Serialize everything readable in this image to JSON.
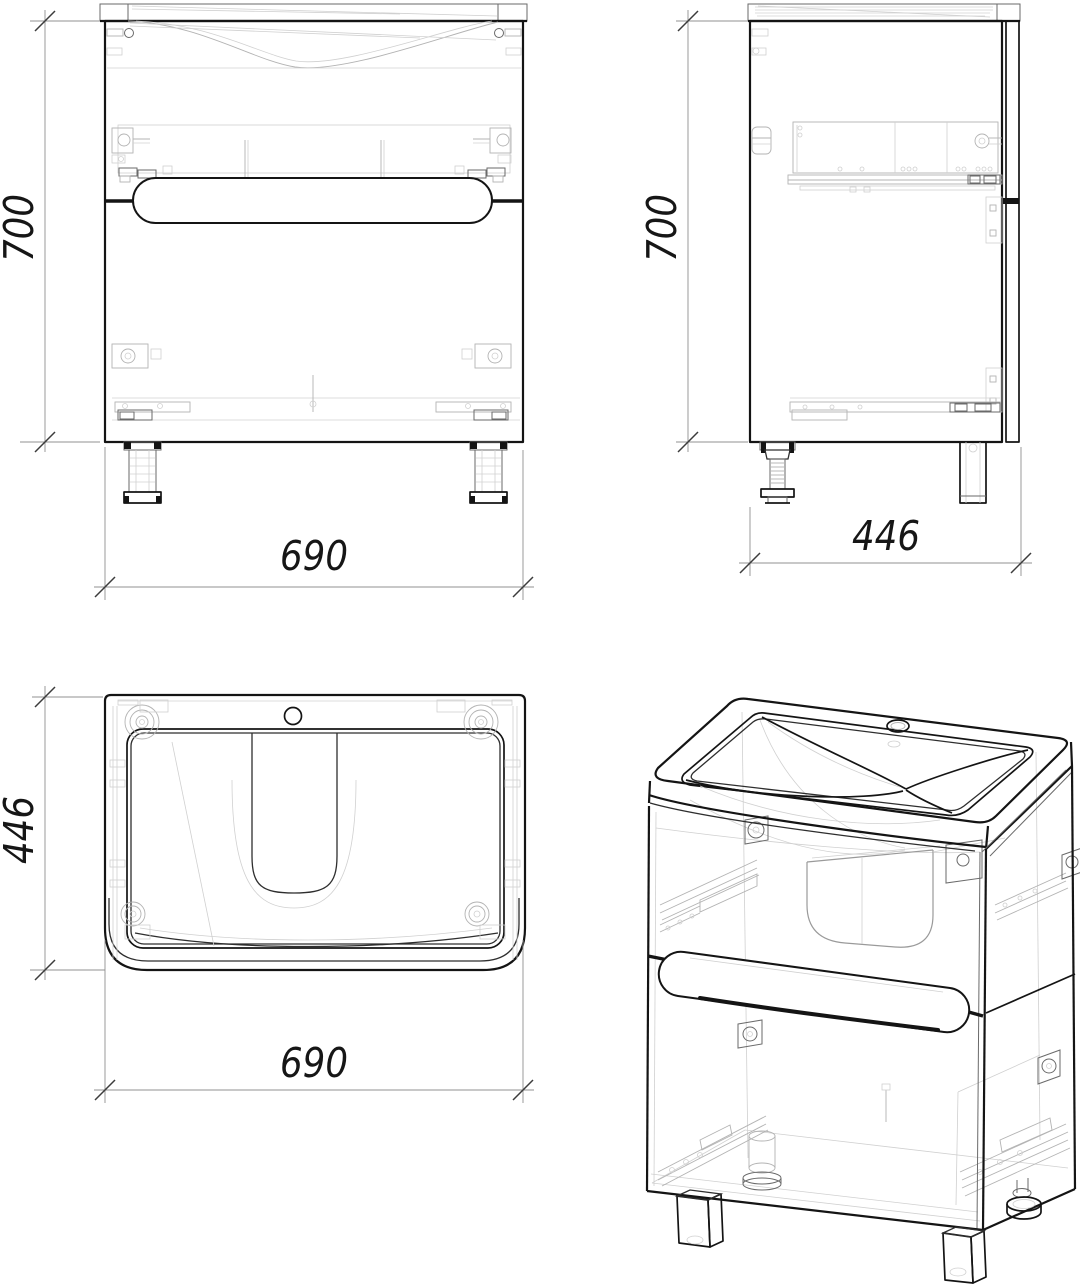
{
  "page": {
    "width": 1080,
    "height": 1284,
    "background": "#ffffff"
  },
  "drawing": {
    "type": "technical-drawing",
    "subject": "vanity cabinet with washbasin, two drawers and adjustable feet",
    "colors": {
      "outline": "#141414",
      "medium_line": "#6a6a6a",
      "light_line": "#b3b3b3",
      "dimension_line": "#909090",
      "text": "#161616"
    },
    "dimensions": {
      "front_height": "700",
      "front_width": "690",
      "side_height": "700",
      "side_depth": "446",
      "top_depth": "446",
      "top_width": "690"
    }
  }
}
